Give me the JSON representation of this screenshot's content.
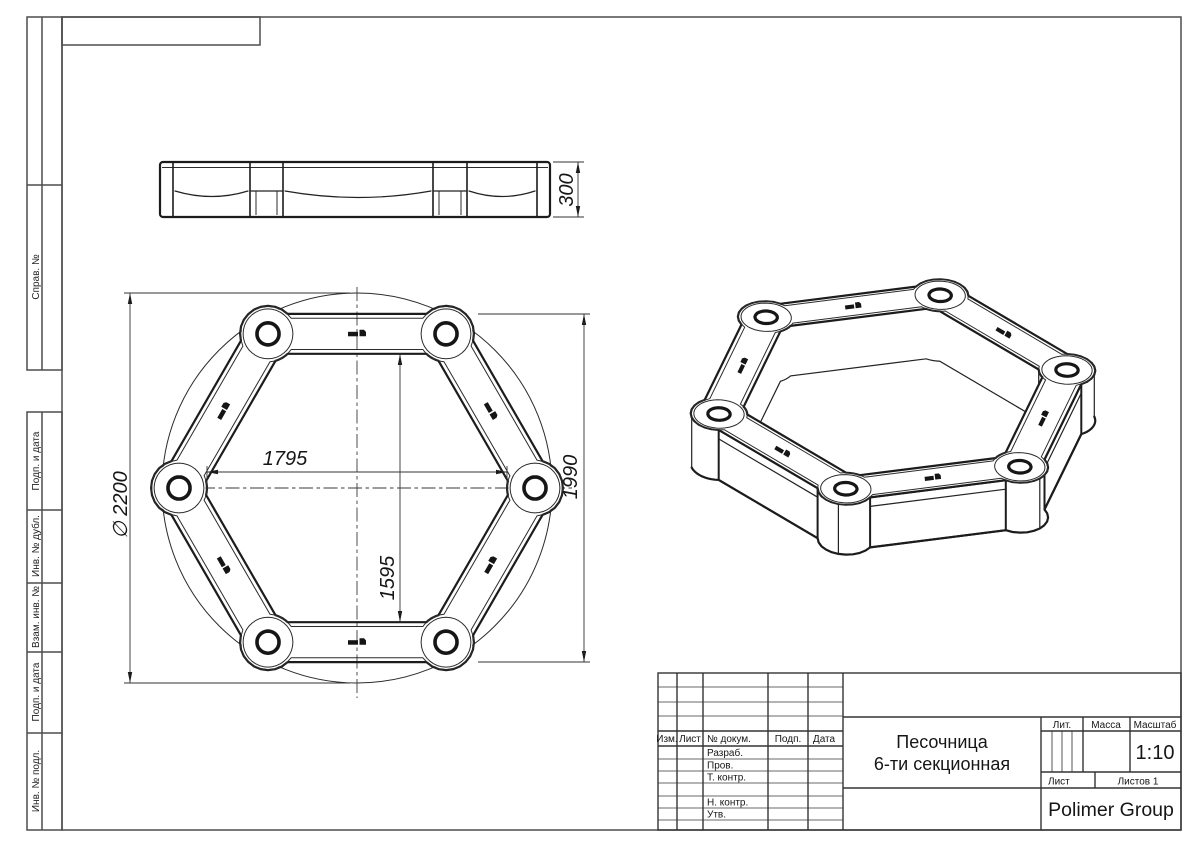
{
  "sheet_margin": {
    "sprav_no": "Справ. №",
    "podp_i_data_1": "Подп. и дата",
    "inv_no_dubl": "Инв. № дубл.",
    "vzam_inv_no": "Взам. инв. №",
    "podp_i_data_2": "Подп. и дата",
    "inv_no_podl": "Инв. № подл."
  },
  "title_block": {
    "col_izm": "Изм.",
    "col_list": "Лист",
    "col_no_dokum": "№ докум.",
    "col_podp": "Подп.",
    "col_data": "Дата",
    "row_razrab": "Разраб.",
    "row_prov": "Пров.",
    "row_t_kontr": "Т. контр.",
    "row_n_kontr": "Н. контр.",
    "row_utv": "Утв.",
    "doc_name_line1": "Песочница",
    "doc_name_line2": "6-ти секционная",
    "lit_label": "Лит.",
    "massa_label": "Масса",
    "masshtab_label": "Масштаб",
    "scale_value": "1:10",
    "list_label": "Лист",
    "listov_label": "Листов 1",
    "company": "Polimer Group"
  },
  "dimensions": {
    "overall_diameter": "∅ 2200",
    "inner_width": "1795",
    "across_flats": "1990",
    "inner_across_flats": "1595",
    "height": "300"
  },
  "colors": {
    "line": "#1c1c1c",
    "frame": "#4d4d4d",
    "background": "#ffffff"
  }
}
